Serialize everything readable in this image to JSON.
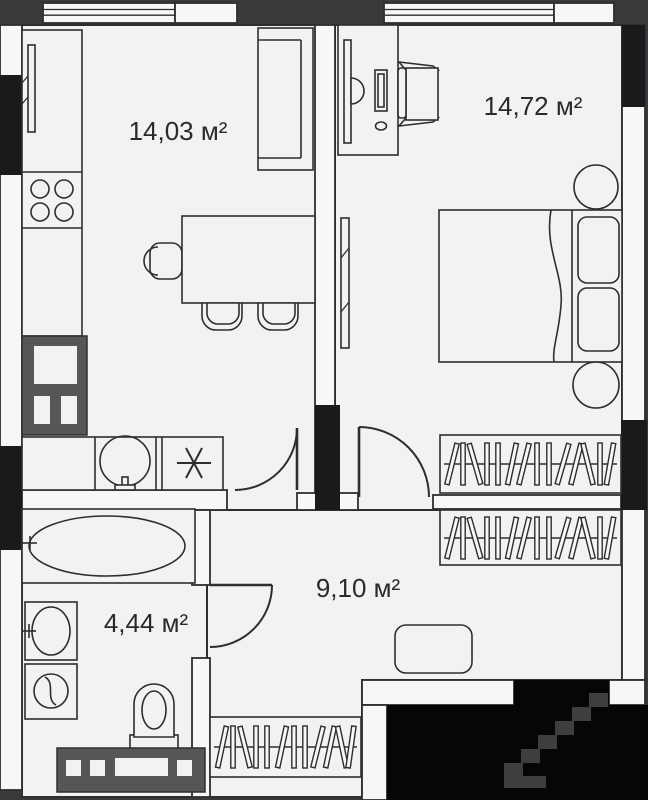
{
  "plan": {
    "rooms": {
      "kitchen_living": {
        "area": "14,03 м²"
      },
      "bedroom": {
        "area": "14,72 м²"
      },
      "hallway": {
        "area": "9,10 м²"
      },
      "bathroom": {
        "area": "4,44 м²"
      }
    },
    "colors": {
      "background": "#39393b",
      "floor": "#f2f2f3",
      "wall": "#f7f7f8",
      "outline": "#2e2e31",
      "black_wall": "#1a1a1c",
      "entry_void": "#060607",
      "steps": "#3e3e40",
      "shaft": "#565658",
      "label_text": "#2a2a2c"
    }
  }
}
